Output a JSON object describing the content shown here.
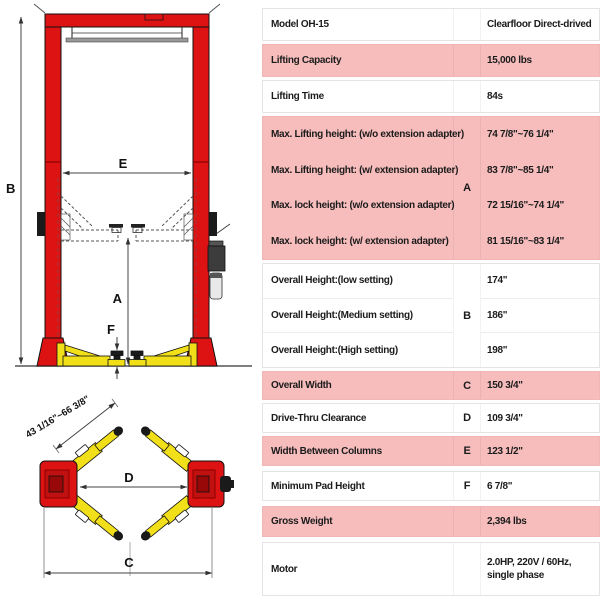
{
  "diagram": {
    "front_view": {
      "label_b": "B",
      "label_e": "E",
      "label_a": "A",
      "label_f": "F"
    },
    "top_view": {
      "label_c": "C",
      "label_d": "D",
      "arm_reach": "43 1/16\"~66 3/8\""
    },
    "colors": {
      "column_red": "#dd1313",
      "arm_yellow": "#f1df1a",
      "pad_black": "#1a1a1a"
    }
  },
  "spec_table": {
    "colors": {
      "highlight_pink": "#f7bdbd",
      "row_border": "#e4e4e4",
      "text": "#1b1b1b"
    },
    "groups": [
      {
        "label": "Model OH-15",
        "letter": "",
        "value": "Clearfloor Direct-drived",
        "pink": false
      },
      {
        "label": "Lifting Capacity",
        "letter": "",
        "value": "15,000 lbs",
        "pink": true
      },
      {
        "label": "Lifting Time",
        "letter": "",
        "value": "84s",
        "pink": false
      },
      {
        "letter": "A",
        "pink": true,
        "rows": [
          {
            "label": "Max. Lifting height: (w/o extension adapter)",
            "value": "74 7/8\"~76 1/4\""
          },
          {
            "label": "Max. Lifting height:  (w/ extension adapter)",
            "value": "83 7/8\"~85 1/4\""
          },
          {
            "label": "Max. lock height:  (w/o extension adapter)",
            "value": "72 15/16\"~74 1/4\""
          },
          {
            "label": "Max. lock height:  (w/ extension adapter)",
            "value": "81 15/16\"~83 1/4\""
          }
        ]
      },
      {
        "letter": "B",
        "pink": false,
        "rows": [
          {
            "label": "Overall Height:(low setting)",
            "value": "174\""
          },
          {
            "label": "Overall Height:(Medium setting)",
            "value": "186\""
          },
          {
            "label": "Overall Height:(High setting)",
            "value": "198\""
          }
        ]
      },
      {
        "label": "Overall Width",
        "letter": "C",
        "value": "150 3/4\"",
        "pink": true
      },
      {
        "label": "Drive-Thru Clearance",
        "letter": "D",
        "value": "109 3/4\"",
        "pink": false
      },
      {
        "label": "Width Between Columns",
        "letter": "E",
        "value": "123 1/2\"",
        "pink": true
      },
      {
        "label": "Minimum Pad Height",
        "letter": "F",
        "value": "6 7/8\"",
        "pink": false
      },
      {
        "label": "Gross Weight",
        "letter": "",
        "value": "2,394 lbs",
        "pink": true
      },
      {
        "label": "Motor",
        "letter": "",
        "value": "2.0HP, 220V / 60Hz, single phase",
        "pink": false
      }
    ]
  }
}
